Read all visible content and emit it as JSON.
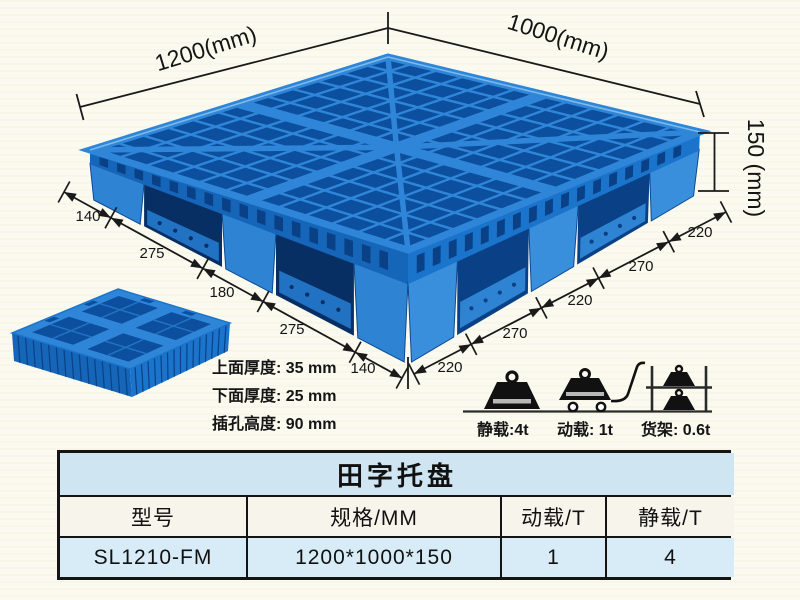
{
  "diagram": {
    "length_label": "1200(mm)",
    "width_label": "1000(mm)",
    "height_label": "150 (mm)",
    "left_edge_dims": [
      "140",
      "275",
      "180",
      "275",
      "140"
    ],
    "right_edge_dims": [
      "220",
      "270",
      "220",
      "270",
      "220"
    ],
    "thickness_notes": [
      "上面厚度: 35 mm",
      "下面厚度: 25 mm",
      "插孔高度: 90 mm"
    ]
  },
  "load_ratings": [
    {
      "icon": "static-load-weight-icon",
      "label": "静载:4t"
    },
    {
      "icon": "dynamic-load-cart-icon",
      "label": "动载: 1t"
    },
    {
      "icon": "rack-load-shelf-icon",
      "label": "货架: 0.6t"
    }
  ],
  "table": {
    "title": "田字托盘",
    "headers": [
      "型号",
      "规格/MM",
      "动载/T",
      "静载/T"
    ],
    "rows": [
      [
        "SL1210-FM",
        "1200*1000*150",
        "1",
        "4"
      ]
    ]
  },
  "colors": {
    "pallet_light": "#2f86d8",
    "pallet_mid_left": "#1565b8",
    "pallet_mid_right": "#1b74cb",
    "pallet_dark": "#0c4f9e",
    "pallet_deep": "#082f63",
    "foot_left": "#2e84d3",
    "foot_right": "#3a8fdc",
    "line_color": "#1a1a1a",
    "table_title_bg": "#cfe5f1",
    "table_header_bg": "#f7f4ec",
    "table_row_bg": "#d8ecf8"
  }
}
